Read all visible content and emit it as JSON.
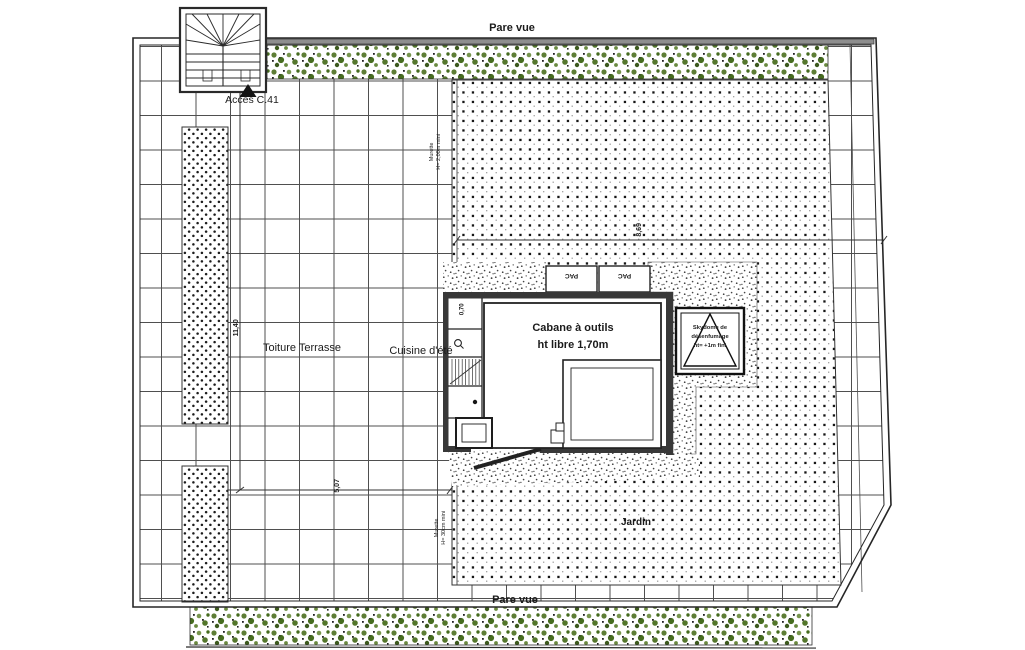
{
  "labels": {
    "pare_vue_top": "Pare vue",
    "pare_vue_bottom": "Pare vue",
    "access": "Accès C.41",
    "toiture_terrasse": "Toiture Terrasse",
    "cuisine_ete": "Cuisine d'été",
    "cabane_line1": "Cabane à outils",
    "cabane_line2": "ht libre 1,70m",
    "jardin": "Jardin",
    "pac_left": "PAC",
    "pac_right": "PAC",
    "skydome_line1": "Skydome de",
    "skydome_line2": "désenfumage",
    "skydome_line3": "ht= +1m fini"
  },
  "dimensions": {
    "terrace_length": "11,40",
    "terrace_width": "5,07",
    "garden_width": "8,69",
    "cell_width": "0,70"
  },
  "notes": {
    "wall_top_line1": "Murette",
    "wall_top_line2": "H= 2,00m mini",
    "wall_bottom_line1": "Murette",
    "wall_bottom_line2": "H= 30cm mini"
  },
  "colors": {
    "linework": "#2a2a2a",
    "wall_fill": "#3a3a3a",
    "vegetation_green": "#55752e",
    "garden_dot": "#161616",
    "fence_gray": "#8e8e8e",
    "paper": "#ffffff"
  }
}
